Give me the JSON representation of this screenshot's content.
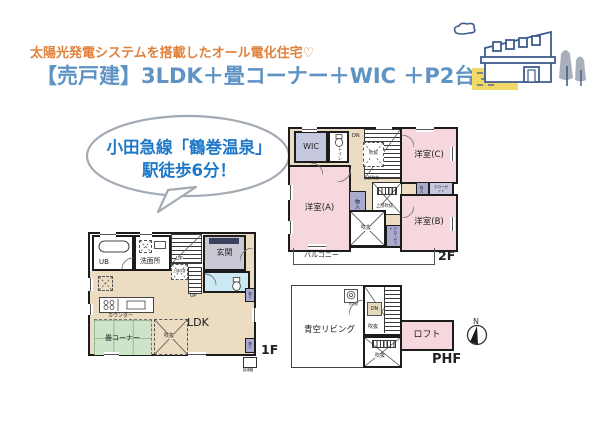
{
  "header": {
    "subtitle": "太陽光発電システムを搭載したオール電化住宅♡",
    "title": "【売戸建】3LDK＋畳コーナー＋WIC ＋P2台"
  },
  "bubble": {
    "line1": "小田急線「鶴巻温泉」",
    "line2": "駅徒歩6分！"
  },
  "labels": {
    "up": "UP",
    "dn": "DN",
    "fukinuke": "吹抜",
    "joubu_fukinuke": "上部吹抜",
    "monoiri": "物入",
    "closet": "クローゼット"
  },
  "floor2": {
    "name": "2F",
    "wic": "WIC",
    "toilet": "トイレ",
    "room_a": "洋室(A)",
    "room_b": "洋室(B)",
    "room_c": "洋室(C)",
    "balcony": "バルコニー"
  },
  "floor1": {
    "name": "1F",
    "ub": "UB",
    "washroom": "洗面所",
    "entrance": "玄関",
    "ldk": "LDK",
    "counter": "カウンター",
    "tatami": "畳コーナー",
    "water_heater": "給湯器"
  },
  "phf": {
    "name": "PHF",
    "sky_living": "青空リビング",
    "loft": "ロフト",
    "tap": "外水栓"
  },
  "compass": {
    "north": "N"
  },
  "colors": {
    "title_blue": "#5f93c4",
    "subtitle_orange": "#e0813c",
    "bubble_text_blue": "#1e78c8",
    "room_pink": "#f6d7de",
    "room_lavender": "#c6c8e0",
    "storage_purple": "#a9abce",
    "hall_beige": "#ecdcc1",
    "entrance_gray": "#c9c9d6",
    "toilet_blue": "#cdeaf4",
    "tatami_green": "#cde4c8",
    "accent_yellow": "#f2d967",
    "illustration_navy": "#3e5c8e",
    "wall_black": "#1c1c1c"
  }
}
